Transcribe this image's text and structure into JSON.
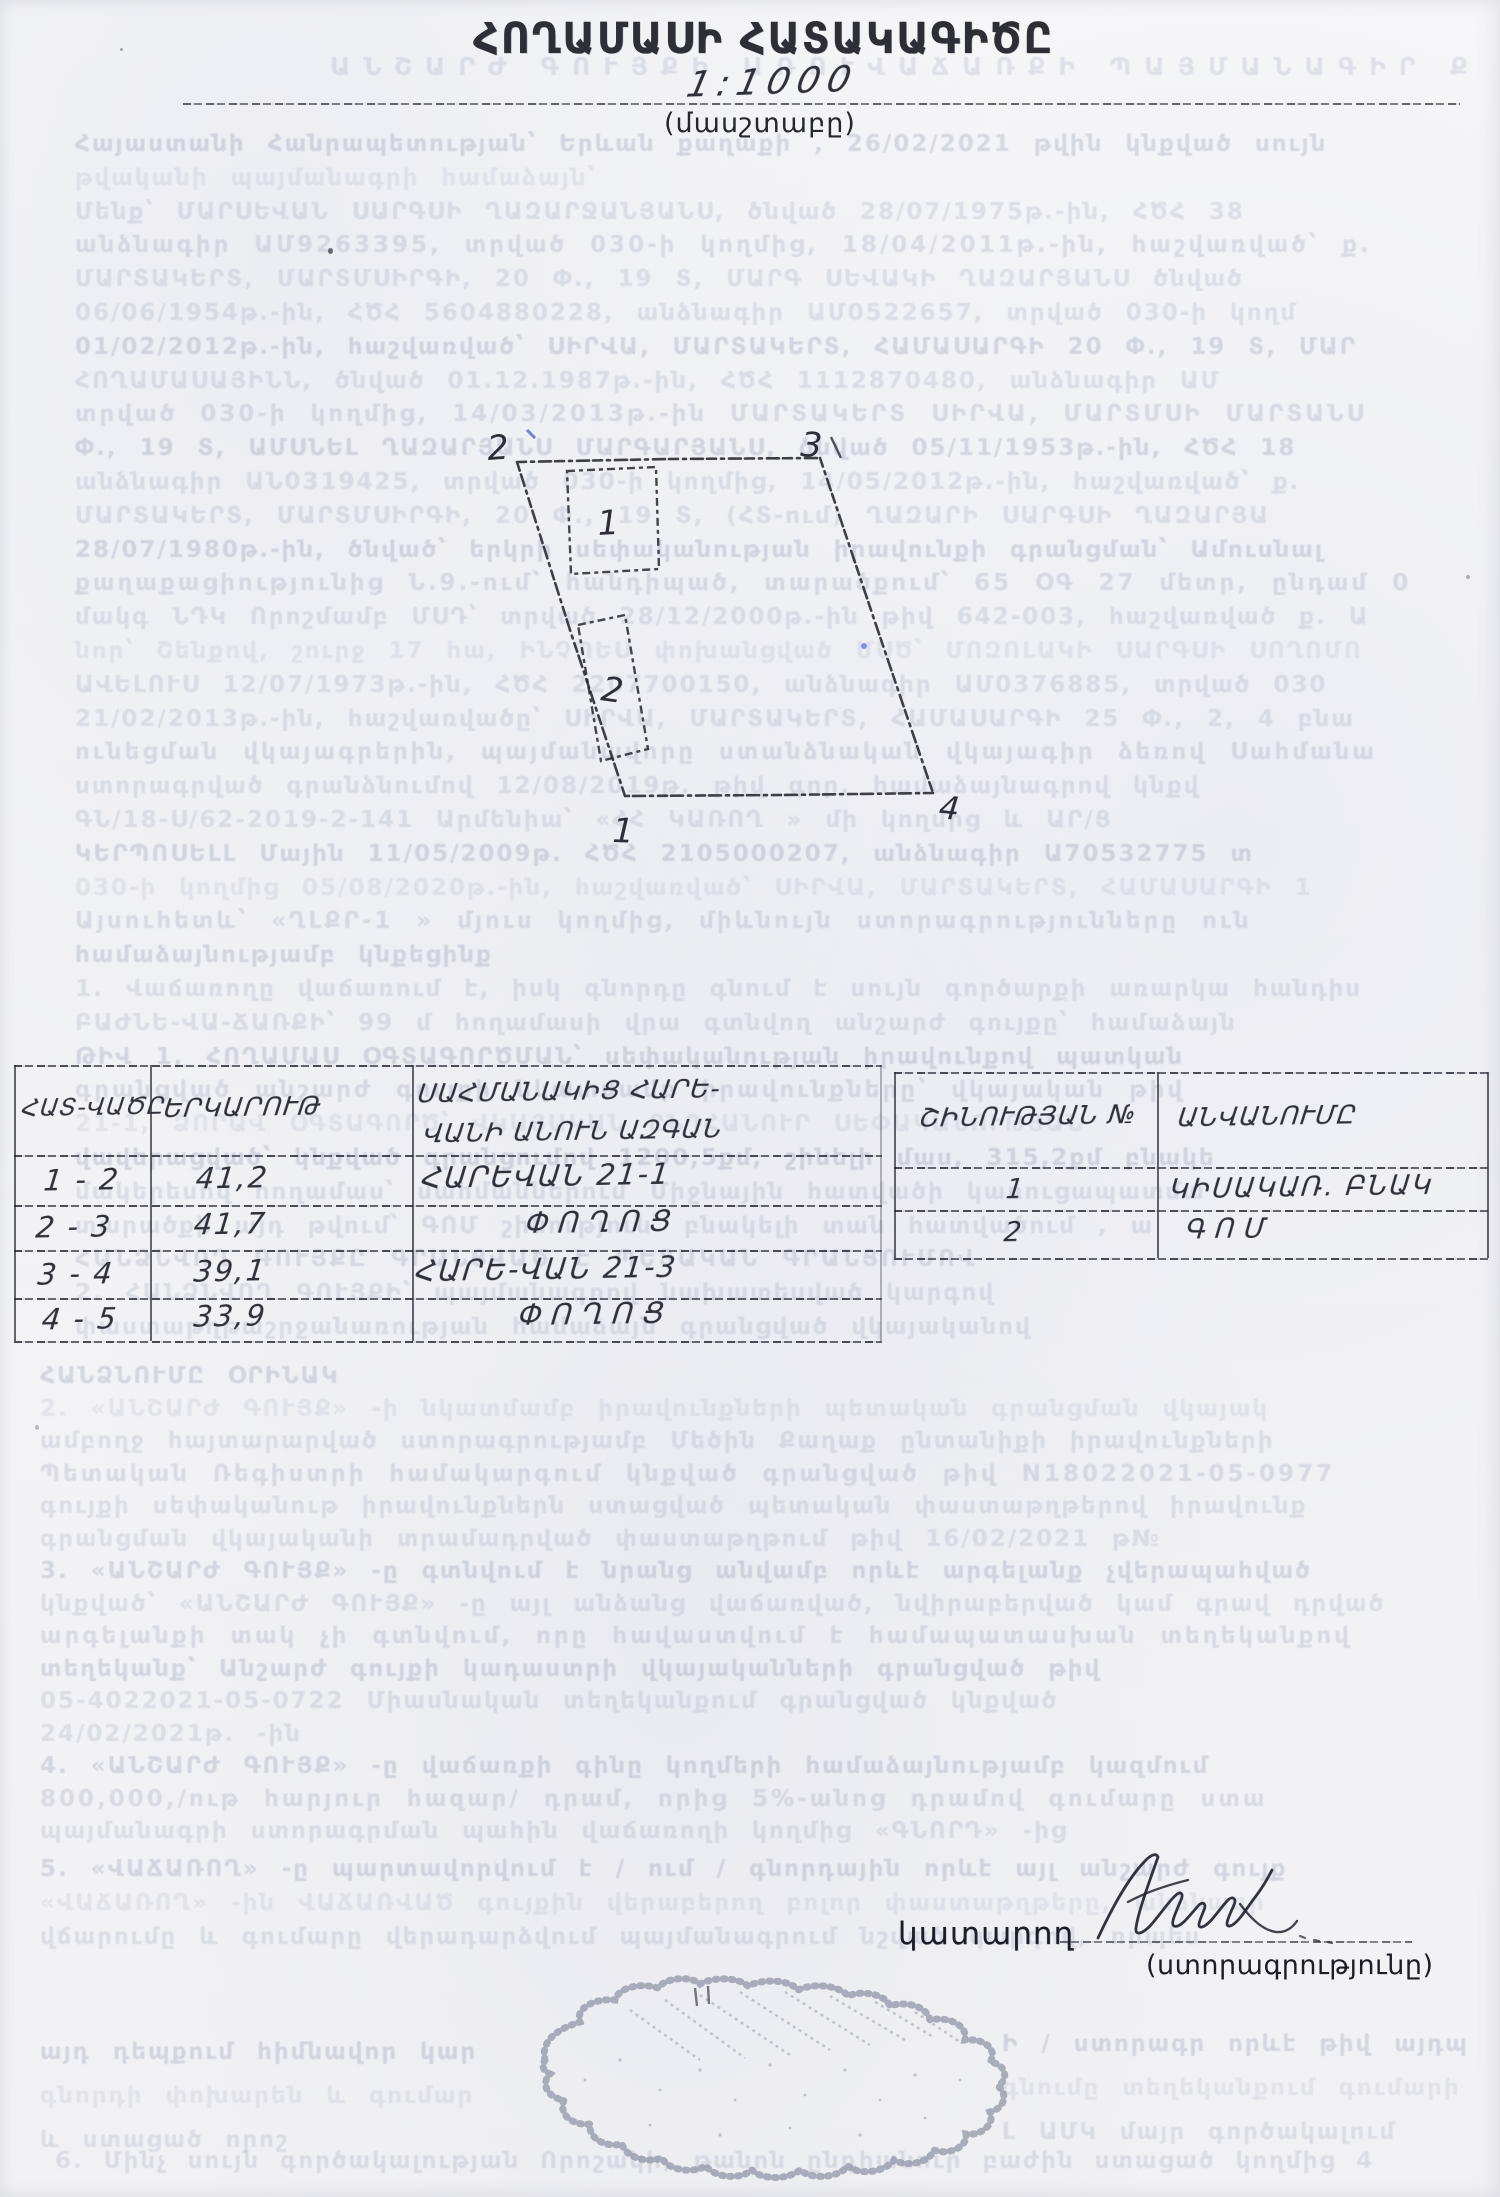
{
  "document": {
    "title": "ՀՈՂԱՄԱՍԻ ՀԱՏԱԿԱԳԻԾԸ",
    "scale_value": "1:1000",
    "scale_label": "(մասշտաբը)"
  },
  "plot": {
    "labels": {
      "p1": "1",
      "p2": "2",
      "p3": "3",
      "p4": "4",
      "b1": "1",
      "b2": "2"
    }
  },
  "measurements_table": {
    "headers": {
      "segment": "ՀԱՏ-ՎԱԾԸ",
      "length": "ԵՐԿԱՐՈՒԹ",
      "neighbor_line1": "ՍԱՀՄԱՆԱԿԻՑ ՀԱՐԵ-",
      "neighbor_line2": "ՎԱՆԻ ԱՆՈՒՆ ԱԶԳԱՆ"
    },
    "rows": [
      [
        "1 - 2",
        "41,2",
        "ՀԱՐԵՎԱՆ 21-1"
      ],
      [
        "2 - 3",
        "41,7",
        "ՓՈՂՈՑ"
      ],
      [
        "3 - 4",
        "39,1",
        "ՀԱՐԵ-ՎԱՆ 21-3"
      ],
      [
        "4 - 5",
        "33,9",
        "ՓՈՂՈՑ"
      ]
    ]
  },
  "buildings_table": {
    "headers": {
      "number": "ՇԻՆՈՒԹՅԱՆ №",
      "name": "ԱՆՎԱՆՈՒՄԸ"
    },
    "rows": [
      [
        "1",
        "ԿԻՍԱԿԱՌ. ԲՆԱԿ"
      ],
      [
        "2",
        "ԳՈՄ"
      ]
    ]
  },
  "executor": {
    "label": "կատարող",
    "signature_caption": "(ստորագրությունը)"
  },
  "bleed_text": {
    "heading": "ԱՆՇԱՐԺ ԳՈՒՅՔԻ ԱՌՈՒՎԱՃԱՌՔԻ ՊԱՅՄԱՆԱԳԻՐ ՔԱՂ",
    "top": [
      "Հայաստանի Հանրապետության՝ Երևան քաղաքի , 26/02/2021 թվին կնքված սույն",
      "թվականի պայմանագրի համաձայն՝",
      "Մենք՝ ՄԱՐՍԵՎԱՆ ՍԱՐԳՍԻ ՂԱԶԱՐՋԱՆՅԱՆՍ, ծնված 28/07/1975թ.-ին, ՀԾՀ 38",
      "անձնագիր ԱՄ9263395, տրված 030-ի կողմից, 18/04/2011թ.-ին, հաշվառված՝ ք.",
      "ՄԱՐՏԱԿԵՐՏ, ՄԱՐՏՄՍԻՐԳԻ, 20 Փ., 19 Տ, ՄԱՐԳ ՍԵՎԱԿԻ ՂԱԶԱՐՅԱՆՍ ծնված",
      "06/06/1954թ.-ին, ՀԾՀ 5604880228, անձնագիր ԱՄ0522657, տրված 030-ի կողմ",
      "01/02/2012թ.-ին, հաշվառված՝ ՍԻՐՎԱ, ՄԱՐՏԱԿԵՐՏ, ՀԱՄԱՍԱՐԳԻ 20 Փ., 19 Տ, ՄԱՐ",
      "ՀՈՂԱՄԱՍԱՅԻՆՆ, ծնված 01.12.1987թ.-ին, ՀԾՀ 1112870480, անձնագիր ԱՄ",
      "տրված 030-ի կողմից, 14/03/2013թ.-ին ՄԱՐՏԱԿԵՐՏ ՍԻՐՎԱ, ՄԱՐՏՄՍԻ ՄԱՐՏԱՆՍ",
      "Փ., 19 Տ, ԱՄՍՆԵԼ ՂԱԶԱՐՅԱՆՍ ՄԱՐԳԱՐՅԱՆՍ, ծնված 05/11/1953թ.-ին, ՀԾՀ 18",
      "անձնագիր ԱՆ0319425, տրված 030-ի կողմից, 14/05/2012թ.-ին, հաշվառված՝ ք.",
      "ՄԱՐՏԱԿԵՐՏ, ՄԱՐՏՄՍԻՐԳԻ, 20 Փ., 19 Տ, (ՀՏ-ում) ՂԱԶԱՐԻ ՍԱՐԳՍԻ ՂԱԶԱՐՅԱ",
      "28/07/1980թ.-ին, ծնված՝ երկրի սեփականության իրավունքի գրանցման՝ Ամուսնալ",
      "քաղաքացիությունից Ն.9.-ում՝ հանդիպած, տարածքում՝ 65 ՕԳ 27 մետր, ընդամ 0",
      "մակգ ՆԴԿ Որոշմամբ ՄՍԴ՝ տրված 28/12/2000թ.-ին թիվ 642-003, հաշվառված ք. Ա",
      "նոր՝ Շենքով, շուրջ 17 հա, ԻՆՉՊԵՍ փոխանցված ՄՍԾ՝ ՄՈԶՈԼԱԿԻ ՍԱՐԳՍԻ ՍՈՂՈՄՈ",
      "ԱՎԵԼՈՒՍ 12/07/1973թ.-ին, ՀԾՀ 2207700150, անձնագիր ԱՄ0376885, տրված 030",
      "21/02/2013թ.-ին, հաշվառվածը՝ ՍԻՐՎԱ, ՄԱՐՏԱԿԵՐՏ, ՀԱՄԱՍԱՐԳԻ 25 Փ., 2, 4 բնա",
      "ունեցման վկայագրերին, պայմանավորը ստանձնական վկայագիր ձեռով Սահմանա",
      "ստորագրված գրանձնումով 12/08/2019թ. թիվ գոր. համաձայնագրով կնքվ",
      "ԳՆ/18-Ս/62-2019-2-141 Արմենիա՝ «ՀՀ ԿԱՌՈՂ » մի կողմից և ԱՐ/Ց",
      "ԿԵՐՊՈՍԵԼԼ Մային 11/05/2009թ. ՀԾՀ 2105000207, անձնագիր Ա70532775 տ",
      "030-ի կողմից 05/08/2020թ.-ին, հաշվառված՝ ՍԻՐՎԱ, ՄԱՐՏԱԿԵՐՏ, ՀԱՄԱՍԱՐԳԻ 1",
      "Այսուհետև՝ «ՂԼՔՐ-1 » մյուս կողմից, միևնույն ստորագրությունները ուն",
      "համաձայնությամբ կնքեցինք",
      "1. Վաճառողը վաճառում է, իսկ գնորդը գնում է սույն գործարքի առարկա հանդիս",
      "ԲԱԺՆԵ-ՎԱ-ՃԱՌՔԻ՝ 99 մ հողամասի վրա գտնվող անշարժ գույքը՝ համաձայն",
      "ԹԻՎ 1, ՀՈՂԱՄԱՍ ՕԳՏԱԳՈՐԾՄԱՆ՝ սեփականության իրավունքով պատկան",
      "գրանցված անշարժ գույքի նկատմամբ իրավունքները՝ վկայական թիվ",
      "21-1, ՁՈՐԱՎ ՕԳՏԱԳՈՐԾ՝ ՎԿԱՅԱԿԱՆ ԸՆԴՀԱՆՈՒՐ ՍԵՓԱԿԱՆՈՒԹՅԱՆ",
      "վավերացված՝ կնքված գրանցումով 1200,5քմ, շինելի մաս, 315,2քմ բնակե",
      "մակերեսով հողամաս՝ սահմաններում Միջնային հատվածի կառուցապատմա",
      "տարածքի այդ թվում՝ ԳՈՄ շինություն՝ բնակելի տան հատվածում , ա",
      "ՀԱՆՁՆՎՈՂ ԳՈՒՅՔԸ ԳՐԱՆՑՎԱԾ Է ՊԵՏԱԿԱՆ ԳՐԱՆՑՈՒՄՈՎ",
      "2. ՀԱՆՁՆՎՈՂ ԳՈՒՅՔԻ՝ պայմանագրով նախատեսված կարգով",
      "փաստաթղթաշրջանառության համաձայն գրանցված վկայականով"
    ],
    "mid": [
      "ՀԱՆՁՆՈՒՄԸ ՕՐԻՆԱԿ",
      "2. «ԱՆՇԱՐԺ ԳՈՒՅՔ» -ի նկատմամբ իրավունքների պետական գրանցման վկայակ",
      "ամբողջ հայտարարված ստորագրությամբ Մեծին Քաղաք ընտանիքի իրավունքների",
      "Պետական Ռեգիստրի համակարգում կնքված գրանցված թիվ N18022021-05-0977",
      "գույքի սեփականութ իրավունքներն ստացված պետական փաստաթղթերով իրավունք",
      "գրանցման վկայականի տրամադրված փաստաթղթում թիվ 16/02/2021 թ№",
      "3. «ԱՆՇԱՐԺ ԳՈՒՅՔ» -ը գտնվում է նրանց անվամբ որևէ արգելանք չվերապահված",
      "կնքված՝ «ԱՆՇԱՐԺ ԳՈՒՅՔ» -ը այլ անձանց վաճառված, նվիրաբերված կամ գրավ դրված",
      "արգելանքի տակ չի գտնվում, որը հավաստվում է համապատասխան տեղեկանքով",
      "տեղեկանք՝ Անշարժ գույքի կադաստրի վկայականների գրանցված թիվ",
      "05-4022021-05-0722 Միասնական տեղեկանքում գրանցված կնքված",
      "24/02/2021թ. -ին",
      "4. «ԱՆՇԱՐԺ ԳՈՒՅՔ» -ը վաճառքի գինը կողմերի համաձայնությամբ կազմում",
      "800,000,/ութ հարյուր հազար/ դրամ, որից 5%-անոց դրամով գումարը ստա",
      "պայմանագրի ստորագրման պահին վաճառողի կողմից «ԳՆՈՐԴ» -ից"
    ],
    "pre_signature": [
      "5. «ՎԱՃԱՌՈՂ» -ը պարտավորվում է / ում / գնորդային որևէ այլ անշարժ գույք",
      "«ՎԱՃԱՌՈՂ» -ին ՎԱՃԱՌՎԱԾ գույքին վերաբերող բոլոր փաստաթղթերը, անձնագր",
      "վճարումը և գումարը վերադարձվում պայմանագրում նշված կարգով, որպես"
    ],
    "bottom_left": [
      "այդ դեպքում հիմնավոր կար",
      "գնորդի փոխարեն և գումար",
      "և ստացած որոշ"
    ],
    "bottom_right": [
      "Ի / ստորագր որևէ թիվ այդպ",
      "գնումը տեղեկանքում գումարի",
      "Լ ԱՄԿ մայր գործակալում"
    ],
    "bottom_line": "6. Մինչ սույն գործակալության Որոշակի, թանոն ընդհանուր բաժին ստացած կողմից 4"
  }
}
